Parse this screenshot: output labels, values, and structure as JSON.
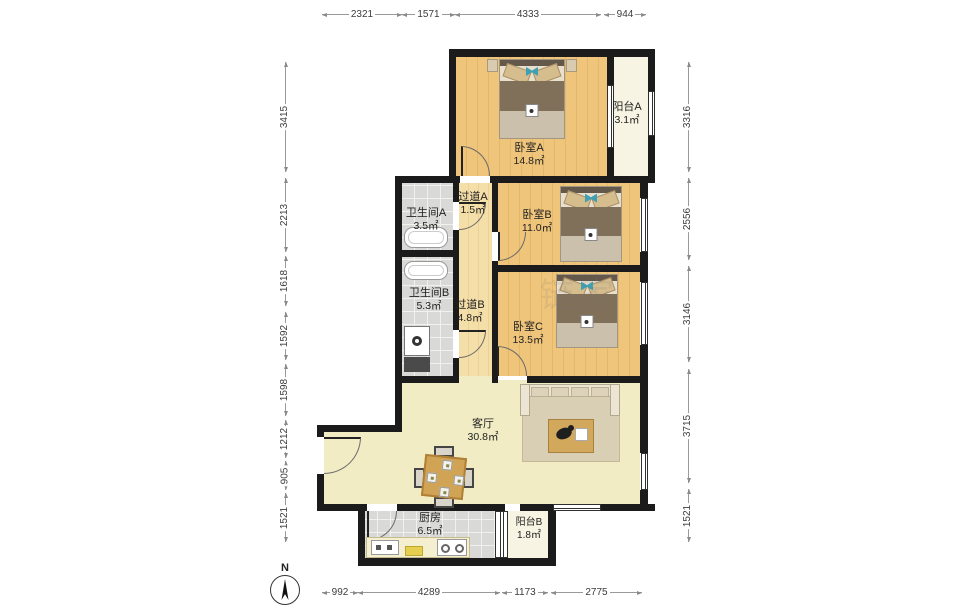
{
  "compass": {
    "label": "N"
  },
  "watermark": "链家",
  "colors": {
    "wall": "#1b1b1b",
    "bedroom_floor": "#efc57b",
    "corridor_floor": "#f5dfa9",
    "living_floor": "#f2ecc5",
    "tile_floor": "#d9dad7",
    "balcony_floor": "#f8f4e3"
  },
  "dimensions": {
    "top": [
      "2321",
      "1571",
      "4333",
      "944"
    ],
    "bottom": [
      "992",
      "4289",
      "1173",
      "2775"
    ],
    "left": [
      "3415",
      "2213",
      "1618",
      "1592",
      "1598",
      "1212",
      "905",
      "1521"
    ],
    "right": [
      "3316",
      "2556",
      "3146",
      "3715",
      "1521"
    ]
  },
  "rooms": {
    "bedroomA": {
      "name": "卧室A",
      "area": "14.8㎡"
    },
    "balconyA": {
      "name": "阳台A",
      "area": "3.1㎡"
    },
    "bathroomA": {
      "name": "卫生间A",
      "area": "3.5㎡"
    },
    "corridorA": {
      "name": "过道A",
      "area": "1.5㎡"
    },
    "bedroomB": {
      "name": "卧室B",
      "area": "11.0㎡"
    },
    "bathroomB": {
      "name": "卫生间B",
      "area": "5.3㎡"
    },
    "corridorB": {
      "name": "过道B",
      "area": "4.8㎡"
    },
    "bedroomC": {
      "name": "卧室C",
      "area": "13.5㎡"
    },
    "living": {
      "name": "客厅",
      "area": "30.8㎡"
    },
    "kitchen": {
      "name": "厨房",
      "area": "6.5㎡"
    },
    "balconyB": {
      "name": "阳台B",
      "area": "1.8㎡"
    }
  }
}
